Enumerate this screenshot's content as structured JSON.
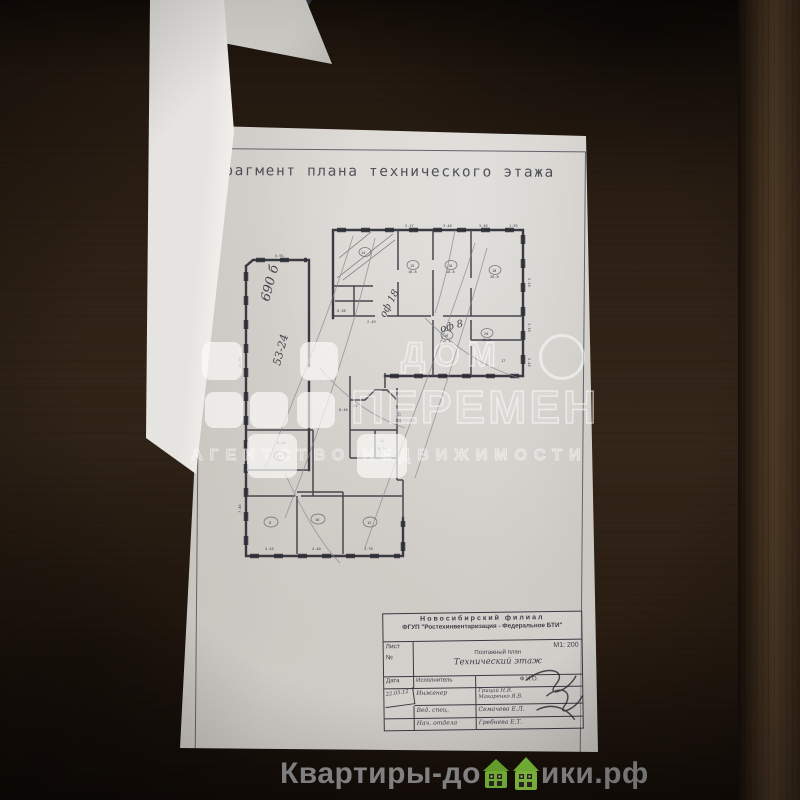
{
  "document": {
    "title": "Фрагмент плана технического этажа",
    "plan": {
      "handwritten": [
        {
          "t": "690 б",
          "x": 44,
          "y": 84,
          "r": -75,
          "s": 13
        },
        {
          "t": "53-24",
          "x": 55,
          "y": 148,
          "r": -75,
          "s": 11
        },
        {
          "t": "оф 18",
          "x": 160,
          "y": 100,
          "r": -62,
          "s": 10
        },
        {
          "t": "оф 8",
          "x": 216,
          "y": 114,
          "r": -14,
          "s": 10
        }
      ],
      "annotations": [
        {
          "t": "5.91",
          "x": 50,
          "y": 39
        },
        {
          "t": "2.17",
          "x": 180,
          "y": 9
        },
        {
          "t": "3.40",
          "x": 218,
          "y": 9
        },
        {
          "t": "3.46",
          "x": 254,
          "y": 9
        },
        {
          "t": "1.55",
          "x": 284,
          "y": 9
        },
        {
          "t": "2.19",
          "x": 303,
          "y": 60,
          "r": 90
        },
        {
          "t": "3.19",
          "x": 303,
          "y": 105,
          "r": 90
        },
        {
          "t": "2.45",
          "x": 303,
          "y": 140,
          "r": 90
        },
        {
          "t": "22.90",
          "x": 16,
          "y": 150,
          "r": -90
        },
        {
          "t": "7.45",
          "x": 16,
          "y": 295,
          "r": -90
        },
        {
          "t": "14",
          "x": 136,
          "y": 36
        },
        {
          "t": "15",
          "x": 185,
          "y": 49
        },
        {
          "t": "16.8",
          "x": 183,
          "y": 55
        },
        {
          "t": "16",
          "x": 223,
          "y": 49
        },
        {
          "t": "18.8",
          "x": 221,
          "y": 55
        },
        {
          "t": "18",
          "x": 267,
          "y": 54
        },
        {
          "t": "20.8",
          "x": 265,
          "y": 60
        },
        {
          "t": "19",
          "x": 219,
          "y": 119
        },
        {
          "t": "18.8",
          "x": 217,
          "y": 125
        },
        {
          "t": "20",
          "x": 259,
          "y": 117
        },
        {
          "t": "16.8",
          "x": 257,
          "y": 123
        },
        {
          "t": "17",
          "x": 276,
          "y": 144
        },
        {
          "t": "8.38",
          "x": 112,
          "y": 94
        },
        {
          "t": "2.49",
          "x": 142,
          "y": 105
        },
        {
          "t": "6.44",
          "x": 52,
          "y": 226
        },
        {
          "t": "13",
          "x": 52,
          "y": 240
        },
        {
          "t": "8",
          "x": 44,
          "y": 306
        },
        {
          "t": "4.45",
          "x": 40,
          "y": 332
        },
        {
          "t": "10",
          "x": 90,
          "y": 303
        },
        {
          "t": "4.40",
          "x": 87,
          "y": 332
        },
        {
          "t": "12",
          "x": 142,
          "y": 306
        },
        {
          "t": "3.70",
          "x": 139,
          "y": 332
        },
        {
          "t": "22.77",
          "x": 176,
          "y": 205,
          "r": -90
        },
        {
          "t": "8.40",
          "x": 114,
          "y": 193
        },
        {
          "t": "21",
          "x": 128,
          "y": 189
        },
        {
          "t": "11",
          "x": 155,
          "y": 224
        },
        {
          "t": "9.10",
          "x": 153,
          "y": 232
        }
      ]
    },
    "stamp": {
      "org_branch": "Новосибирский филиал",
      "org_name": "ФГУП \"Ростехинвентаризация - Федеральное БТИ\"",
      "sheet_label": "Лист",
      "sheet_number_label": "№",
      "scale": "М1: 200",
      "plan_kind": "Поэтажный план",
      "plan_title": "Технический этаж",
      "table": {
        "headers": [
          "Дата",
          "Исполнитель",
          "Ф.И.О."
        ],
        "rows": [
          {
            "date": "22.05.12",
            "role": "Инженер",
            "name_line1": "Грицай Н.В.",
            "name_line2": "Макаренко Я.В."
          },
          {
            "date": "",
            "role": "Вед. спец.",
            "name": "Семачева Е.Л."
          },
          {
            "date": "",
            "role": "Нач. отдела",
            "name": "Гребнева Е.Т."
          }
        ]
      }
    }
  },
  "watermark": {
    "line1": "ДОМ",
    "line2": "ПЕРЕМЕН",
    "line3": "АГЕНТСТВО НЕДВИЖИМОСТИ",
    "color": "#ffffff"
  },
  "caption": {
    "prefix": "Квартиры-до",
    "suffix": "ики.рф",
    "full_reading": "Квартиры-домики.рф",
    "icon": "house-icons",
    "text_color": "#8f8f8f",
    "house_green": "#7cbf3a"
  }
}
